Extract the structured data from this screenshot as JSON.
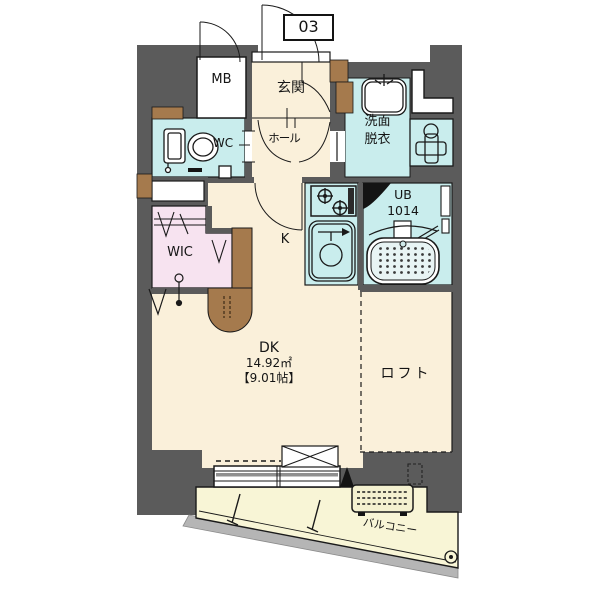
{
  "floorplan": {
    "unit_number": "03",
    "rooms": {
      "meter_box": {
        "label": "MB"
      },
      "entrance": {
        "label": "玄関"
      },
      "toilet": {
        "label": "WC"
      },
      "hall": {
        "label": "ホール"
      },
      "washroom": {
        "line1": "洗面",
        "line2": "脱衣"
      },
      "unit_bath": {
        "line1": "UB",
        "line2": "1014"
      },
      "walk_in_closet": {
        "label": "WIC"
      },
      "kitchen": {
        "label": "K"
      },
      "dining_kitchen": {
        "label": "DK",
        "area_sqm": "14.92㎡",
        "area_tatami": "【9.01帖】"
      },
      "loft": {
        "label": "ロフト"
      },
      "balcony": {
        "label": "バルコニー"
      }
    },
    "colors": {
      "wall": "#5b5b5b",
      "flooring": "#faf0da",
      "wet_area": "#c9eded",
      "closet": "#f7e3f0",
      "balcony": "#f8f5d6",
      "wood_accent": "#a57a4d",
      "outline": "#1a1a1a"
    }
  }
}
